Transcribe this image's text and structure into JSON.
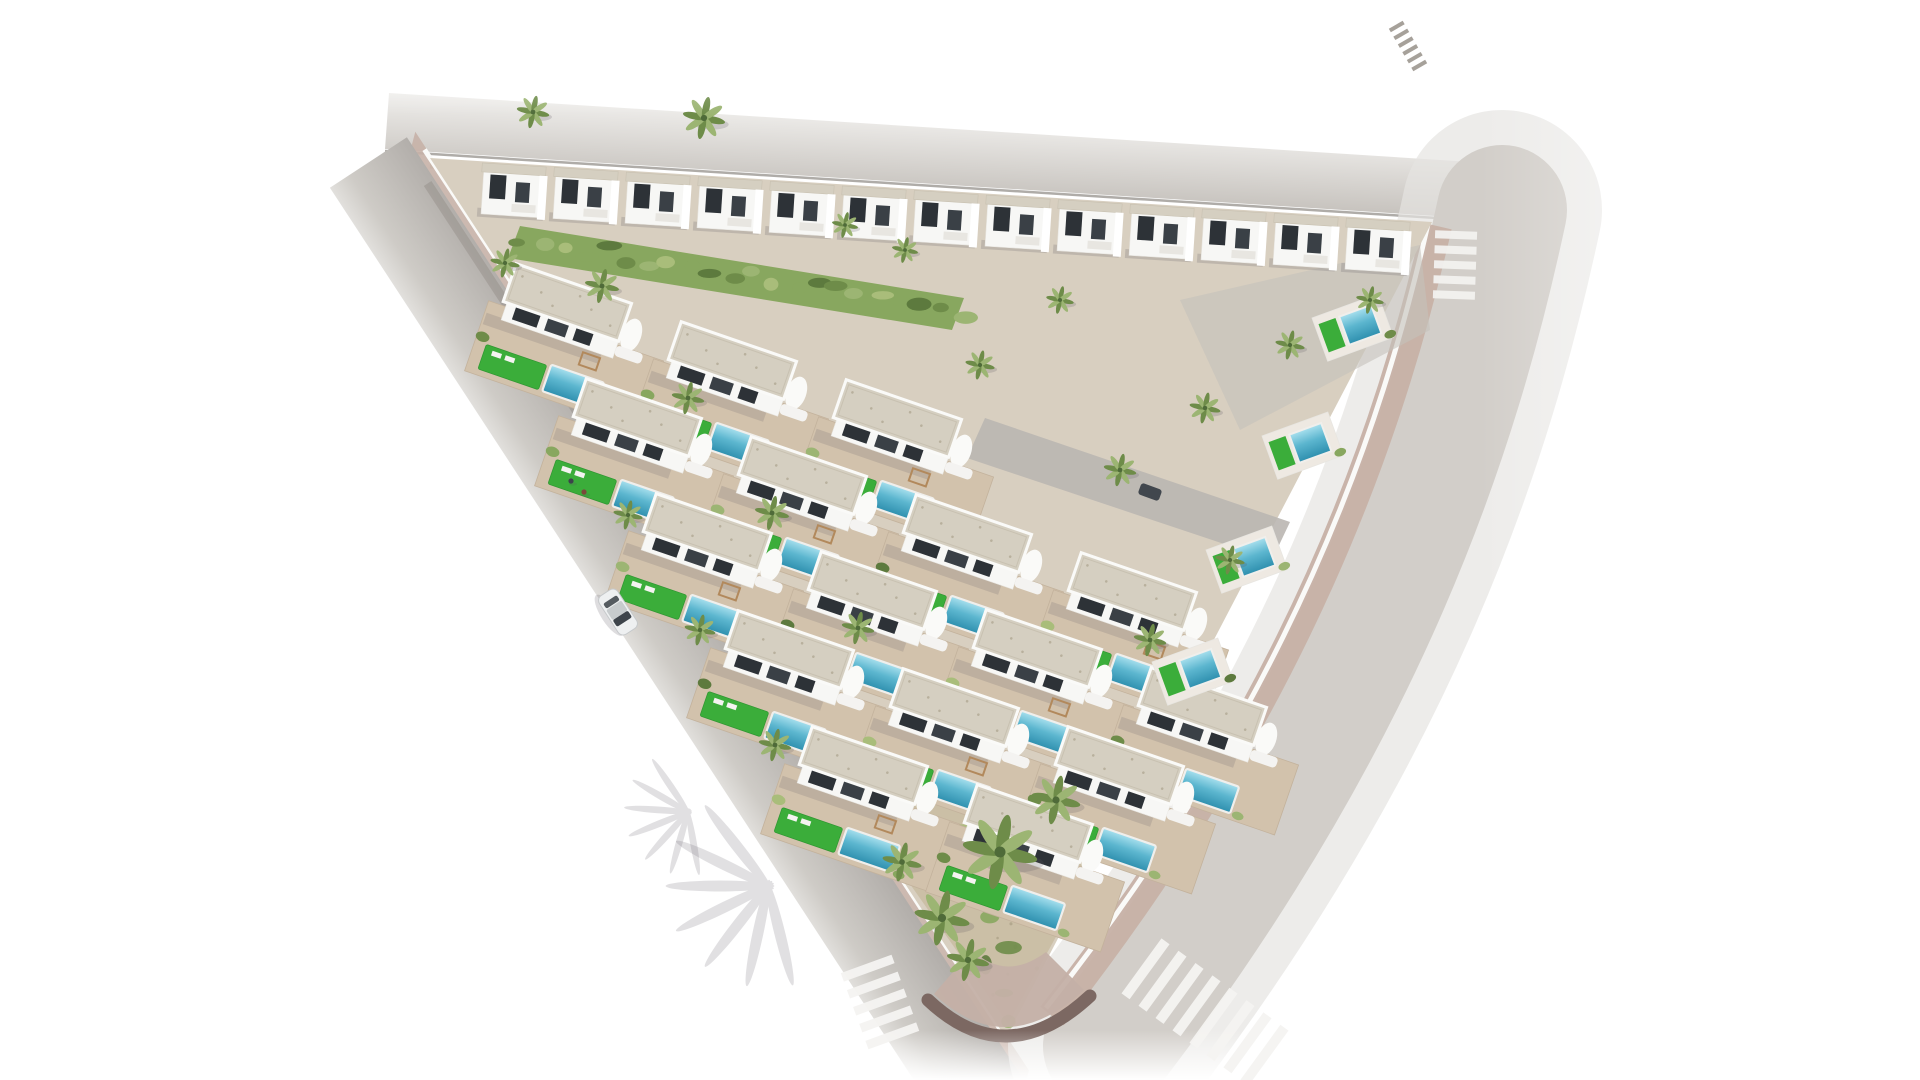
{
  "scene": {
    "title": "Aerial render of triangular white-villa development with pools and palm trees",
    "canvas": {
      "width": 1920,
      "height": 1080
    },
    "colors": {
      "background": "#ffffff",
      "road": "#b4b0ab",
      "roadLight": "#d2cec9",
      "roadSoft": "#e6e4e1",
      "roadFade": "#efeeec",
      "curb": "#8e8a84",
      "wallShadowLine": "#8d8781",
      "sidewalkPink": "#c7b1a7",
      "stoneWall": "#cfc5b0",
      "stoneWallTop": "#b5a98f",
      "apexWall": "#7c6862",
      "apexCobble": "#c4b0a6",
      "ground": "#d8cfc0",
      "terrace": "#d2c2ac",
      "terraceEdge": "#c3b29c",
      "wallWhite": "#f7f7f5",
      "wallShade": "#e8e6e1",
      "roofGravel": "#d5cfc1",
      "roofEdge": "#c8c1b1",
      "roofSpeckle": "#b8b09d",
      "parapet": "#fafaf8",
      "windowDark": "#2d3237",
      "windowMid": "#3a4046",
      "lawn": "#3bad3a",
      "lawnEdge": "#2f9631",
      "poolTop": "#a8e0ee",
      "poolMid": "#5cb6cf",
      "poolDeep": "#2e8fae",
      "poolCoping": "#f0efec",
      "gardenGround": "#cbbfa6",
      "gardenSpeckle": "#b3a88e",
      "veg": [
        "#6e8c49",
        "#88a75f",
        "#9cb573",
        "#5d7a3e",
        "#a9bd7a"
      ],
      "trunk": "#8a7354",
      "palmCore": "#4f6b39",
      "wood": "#b2895c",
      "shadow": "rgba(88,84,96,0.20)",
      "softShadow": "rgba(95,90,102,0.18)",
      "carBody": "#eef0f1",
      "carGlass": "#3e444b",
      "carRoof": "#c7cbcd",
      "parkedCar": "#41474e",
      "stripeWhite": "#f4f3f1",
      "stripeGhost": "#a19c95"
    },
    "triangle": {
      "topLeft": [
        430,
        158
      ],
      "topRight": [
        1432,
        222
      ],
      "apex": [
        1006,
        1038
      ]
    },
    "backRow": {
      "start": [
        484,
        168
      ],
      "step": [
        72,
        4.6
      ],
      "count": 13
    },
    "villaRows": {
      "angle": 19,
      "step": [
        165,
        58
      ],
      "rows": [
        {
          "start": [
            520,
            265
          ],
          "count": 3
        },
        {
          "start": [
            590,
            380
          ],
          "count": 4
        },
        {
          "start": [
            660,
            495
          ],
          "count": 4
        },
        {
          "start": [
            742,
            612
          ],
          "count": 3
        },
        {
          "start": [
            816,
            728
          ],
          "count": 2
        }
      ]
    },
    "rightPads": [
      [
        1312,
        318
      ],
      [
        1262,
        436
      ],
      [
        1206,
        550
      ],
      [
        1152,
        662
      ]
    ],
    "internalStreet": [
      [
        985,
        418
      ],
      [
        1290,
        522
      ],
      [
        1272,
        560
      ],
      [
        967,
        458
      ]
    ],
    "driveway": [
      [
        1180,
        300
      ],
      [
        1420,
        245
      ],
      [
        1430,
        330
      ],
      [
        1240,
        430
      ]
    ],
    "parkedCar": {
      "x": 1150,
      "y": 492,
      "angle": 20
    },
    "slopeStrip": [
      [
        520,
        226
      ],
      [
        964,
        298
      ],
      [
        952,
        330
      ],
      [
        508,
        258
      ]
    ],
    "garden": [
      [
        840,
        784
      ],
      [
        1140,
        784
      ],
      [
        1008,
        1024
      ]
    ],
    "gardenBushes": {
      "seed": 7,
      "count": 26,
      "speckles": 40
    },
    "palms": [
      [
        1000,
        852,
        2.3
      ],
      [
        942,
        918,
        1.7
      ],
      [
        1056,
        800,
        1.5
      ],
      [
        902,
        862,
        1.2
      ],
      [
        968,
        960,
        1.3
      ],
      [
        704,
        118,
        1.3
      ],
      [
        533,
        112,
        1.0
      ],
      [
        602,
        286,
        1.05
      ],
      [
        505,
        263,
        0.9
      ],
      [
        688,
        398,
        1.0
      ],
      [
        772,
        513,
        1.05
      ],
      [
        858,
        628,
        1.0
      ],
      [
        628,
        515,
        0.9
      ],
      [
        700,
        630,
        0.95
      ],
      [
        775,
        745,
        1.0
      ],
      [
        1120,
        470,
        1.0
      ],
      [
        1205,
        408,
        0.95
      ],
      [
        1290,
        345,
        0.9
      ],
      [
        1370,
        300,
        0.85
      ],
      [
        980,
        365,
        0.9
      ],
      [
        1060,
        300,
        0.85
      ],
      [
        905,
        250,
        0.8
      ],
      [
        1150,
        640,
        1.0
      ],
      [
        1230,
        560,
        0.9
      ],
      [
        845,
        225,
        0.8
      ]
    ],
    "palmShadows": [
      [
        768,
        886,
        -24,
        1.6
      ],
      [
        688,
        812,
        -20,
        1.0
      ]
    ],
    "crosswalks": [
      {
        "x": 880,
        "y": 1002,
        "angle": 70,
        "n": 5,
        "w": 9,
        "len": 54,
        "gap": 9,
        "color": "#f4f3f1"
      },
      {
        "x": 1205,
        "y": 1012,
        "angle": 36,
        "n": 8,
        "w": 10,
        "len": 68,
        "gap": 11,
        "color": "#f4f3f1"
      },
      {
        "x": 1455,
        "y": 265,
        "angle": 92,
        "n": 5,
        "w": 8,
        "len": 42,
        "gap": 7,
        "color": "#f2f1ef"
      },
      {
        "x": 1408,
        "y": 46,
        "angle": 60,
        "n": 6,
        "w": 4,
        "len": 16,
        "gap": 5,
        "color": "#a19c95"
      }
    ],
    "car": {
      "x": 618,
      "y": 612,
      "angle": 57
    },
    "pedestrians": [
      [
        571,
        481,
        "#3c434b"
      ],
      [
        584,
        492,
        "#7a4a3b"
      ]
    ]
  }
}
